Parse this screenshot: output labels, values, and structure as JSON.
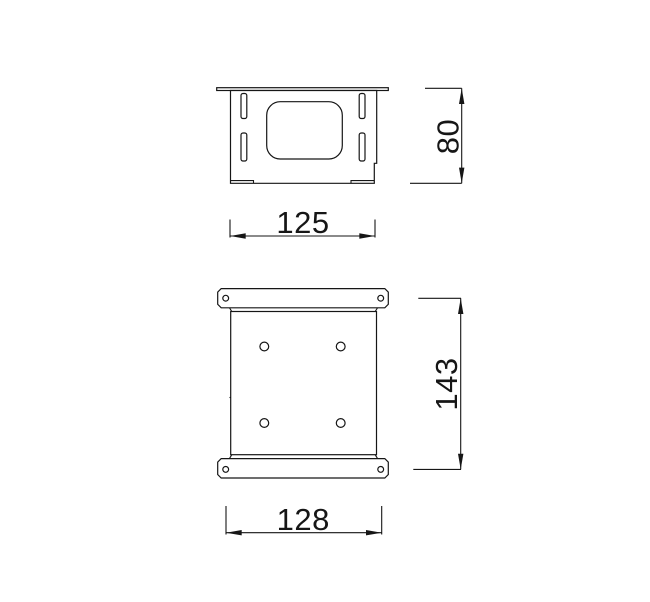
{
  "page": {
    "background": "#ffffff",
    "line_color": "#161616"
  },
  "dimensions": {
    "front_height": {
      "value": "80",
      "orientation": "vertical"
    },
    "front_width": {
      "value": "125",
      "orientation": "horizontal"
    },
    "plan_height": {
      "value": "143",
      "orientation": "vertical"
    },
    "plan_width": {
      "value": "128",
      "orientation": "horizontal"
    }
  }
}
